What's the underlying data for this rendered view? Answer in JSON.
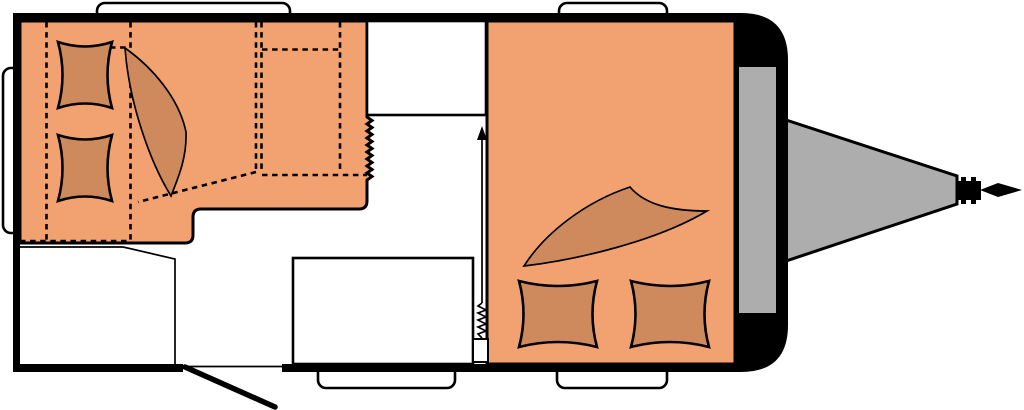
{
  "colors": {
    "body": "#000000",
    "floor": "#ffffff",
    "upholstery": "#f2a271",
    "bedding": "#ce8a5c",
    "metal": "#adadad",
    "window": "#ffffff",
    "cabinet": "#ffffff"
  }
}
